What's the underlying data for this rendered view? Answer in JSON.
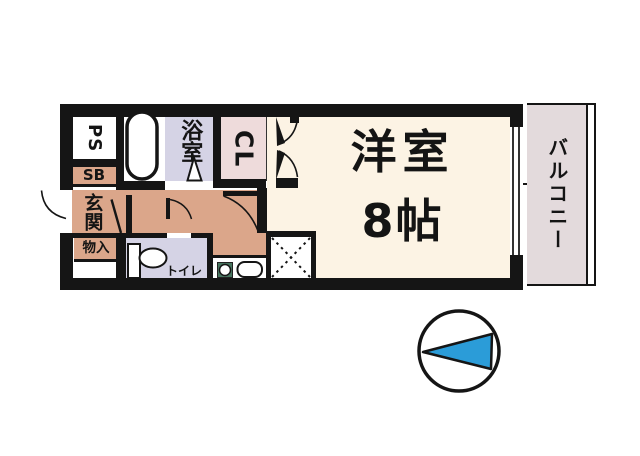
{
  "document": {
    "type": "apartment-floor-plan"
  },
  "rooms": {
    "ps": {
      "label": "PS"
    },
    "sb": {
      "label": "SB"
    },
    "genkan": {
      "label": "玄関"
    },
    "monoire": {
      "label": "物入"
    },
    "bathroom": {
      "label": "浴室"
    },
    "closet": {
      "label": "CL"
    },
    "toilet": {
      "label": "トイレ"
    },
    "living": {
      "label": "洋室",
      "size": "8帖"
    },
    "balcony": {
      "label": "バルコニー"
    }
  },
  "icons": {
    "compass": "north-arrow-circle",
    "bathtub": "bathtub-outline",
    "toilet_fixture": "toilet-plan-symbol",
    "stove": "burner-with-ring",
    "sink": "kitchen-sink",
    "hatch": "service-space-cross-hatch"
  },
  "colors": {
    "wall": "#151515",
    "hall_tan": "#dba68a",
    "room_cream": "#fcf3e4",
    "wet_lavender": "#d5d3e5",
    "closet_pink": "#eedbdb",
    "balcony_pink": "#e3dadc",
    "stove_green": "#47755f",
    "compass_blue": "#2b9cd8"
  },
  "compass": {
    "points": "west-left",
    "shape": "circle-with-triangle"
  }
}
